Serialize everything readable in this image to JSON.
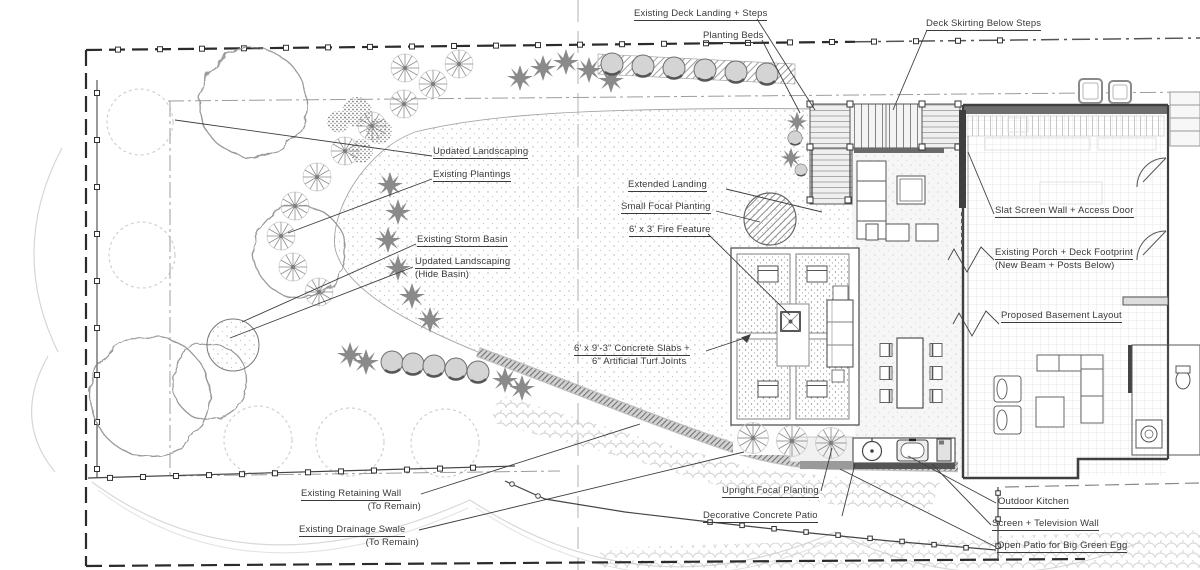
{
  "colors": {
    "ink": "#3a3a3a",
    "wall_line": "#555555",
    "muted_line": "#9a9a9a",
    "faint_line": "#d0d0d0",
    "band_fill": "#bdbdbd",
    "paper": "#ffffff"
  },
  "annotations": {
    "deck_landing": {
      "text": "Existing Deck Landing + Steps"
    },
    "planting_beds": {
      "text": "Planting Beds"
    },
    "deck_skirting": {
      "text": "Deck Skirting Below Steps"
    },
    "updated_landscaping": {
      "text": "Updated Landscaping"
    },
    "existing_plantings": {
      "text": "Existing Plantings"
    },
    "extended_landing": {
      "text": "Extended Landing"
    },
    "small_focal_planting": {
      "text": "Small Focal Planting"
    },
    "fire_feature": {
      "text": "6' x 3' Fire Feature"
    },
    "existing_storm_basin": {
      "text": "Existing Storm Basin"
    },
    "updated_landscaping_hide": {
      "line1": "Updated Landscaping",
      "line2": "(Hide Basin)"
    },
    "slat_screen_wall": {
      "text": "Slat Screen Wall + Access Door"
    },
    "existing_porch": {
      "line1": "Existing Porch + Deck Footprint",
      "line2": "(New Beam + Posts Below)"
    },
    "proposed_basement": {
      "text": "Proposed Basement Layout"
    },
    "concrete_slabs": {
      "line1": "6' x 9'-3\" Concrete Slabs +",
      "line2": "6\" Artificial Turf Joints"
    },
    "retaining_wall": {
      "line1": "Existing Retaining Wall",
      "line2": "(To Remain)"
    },
    "drainage_swale": {
      "line1": "Existing Drainage Swale",
      "line2": "(To Remain)"
    },
    "upright_focal": {
      "text": "Upright Focal Planting"
    },
    "decorative_patio": {
      "text": "Decorative Concrete Patio"
    },
    "outdoor_kitchen": {
      "text": "Outdoor Kitchen"
    },
    "screen_tv": {
      "text": "Screen + Television Wall"
    },
    "open_patio_egg": {
      "text": "Open Patio for Big Green Egg"
    }
  }
}
